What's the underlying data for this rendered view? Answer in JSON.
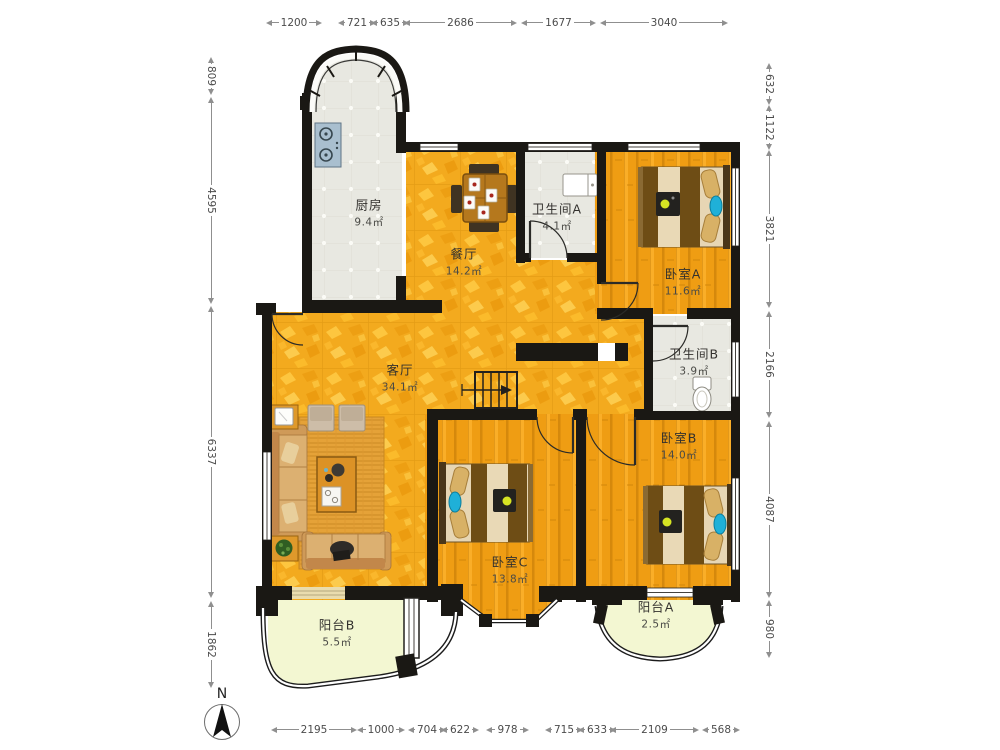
{
  "title": "三室两厅户型图",
  "compass": {
    "label": "N"
  },
  "colors": {
    "gold_tile": "#f3aa1e",
    "wood_floor": "#ef9d13",
    "bath_tile": "#e8e8e1",
    "balcony_floor": "#f3f7d2",
    "wall": "#1a1814",
    "lamp_blue": "#1fb0d8"
  },
  "rooms": [
    {
      "id": "kitchen",
      "name": "厨房",
      "area": "9.4㎡",
      "cx": 369,
      "cy": 212
    },
    {
      "id": "dining",
      "name": "餐厅",
      "area": "14.2㎡",
      "cx": 464,
      "cy": 261
    },
    {
      "id": "bath-a",
      "name": "卫生间A",
      "area": "4.1㎡",
      "cx": 557,
      "cy": 216
    },
    {
      "id": "bedroom-a",
      "name": "卧室A",
      "area": "11.6㎡",
      "cx": 683,
      "cy": 281
    },
    {
      "id": "bath-b",
      "name": "卫生间B",
      "area": "3.9㎡",
      "cx": 694,
      "cy": 361
    },
    {
      "id": "living",
      "name": "客厅",
      "area": "34.1㎡",
      "cx": 400,
      "cy": 377
    },
    {
      "id": "bedroom-b",
      "name": "卧室B",
      "area": "14.0㎡",
      "cx": 679,
      "cy": 445
    },
    {
      "id": "bedroom-c",
      "name": "卧室C",
      "area": "13.8㎡",
      "cx": 510,
      "cy": 569
    },
    {
      "id": "balcony-b",
      "name": "阳台B",
      "area": "5.5㎡",
      "cx": 337,
      "cy": 632
    },
    {
      "id": "balcony-a",
      "name": "阳台A",
      "area": "2.5㎡",
      "cx": 656,
      "cy": 614
    }
  ],
  "dimensions": {
    "top": {
      "y": 22,
      "items": [
        {
          "label": "1200",
          "from": 266,
          "to": 322
        },
        {
          "label": "721",
          "from": 338,
          "to": 371
        },
        {
          "label": "635",
          "from": 371,
          "to": 403
        },
        {
          "label": "2686",
          "from": 404,
          "to": 517
        },
        {
          "label": "1677",
          "from": 521,
          "to": 596
        },
        {
          "label": "3040",
          "from": 600,
          "to": 728
        }
      ]
    },
    "bottom": {
      "y": 729,
      "items": [
        {
          "label": "2195",
          "from": 271,
          "to": 357
        },
        {
          "label": "1000",
          "from": 357,
          "to": 405
        },
        {
          "label": "704",
          "from": 408,
          "to": 438
        },
        {
          "label": "622",
          "from": 441,
          "to": 469
        },
        {
          "label": "978",
          "from": 486,
          "to": 529
        },
        {
          "label": "715",
          "from": 545,
          "to": 576
        },
        {
          "label": "633",
          "from": 578,
          "to": 607
        },
        {
          "label": "2109",
          "from": 610,
          "to": 699
        },
        {
          "label": "568",
          "from": 702,
          "to": 728
        }
      ]
    },
    "left": {
      "x": 212,
      "items": [
        {
          "label": "809",
          "from": 57,
          "to": 95
        },
        {
          "label": "4595",
          "from": 97,
          "to": 304
        },
        {
          "label": "6337",
          "from": 306,
          "to": 598
        },
        {
          "label": "1862",
          "from": 601,
          "to": 688
        }
      ]
    },
    "right": {
      "x": 770,
      "items": [
        {
          "label": "632",
          "from": 63,
          "to": 105
        },
        {
          "label": "1122",
          "from": 105,
          "to": 148
        },
        {
          "label": "3821",
          "from": 150,
          "to": 308
        },
        {
          "label": "2166",
          "from": 311,
          "to": 418
        },
        {
          "label": "4087",
          "from": 421,
          "to": 598
        },
        {
          "label": "980",
          "from": 600,
          "to": 658
        }
      ]
    }
  }
}
